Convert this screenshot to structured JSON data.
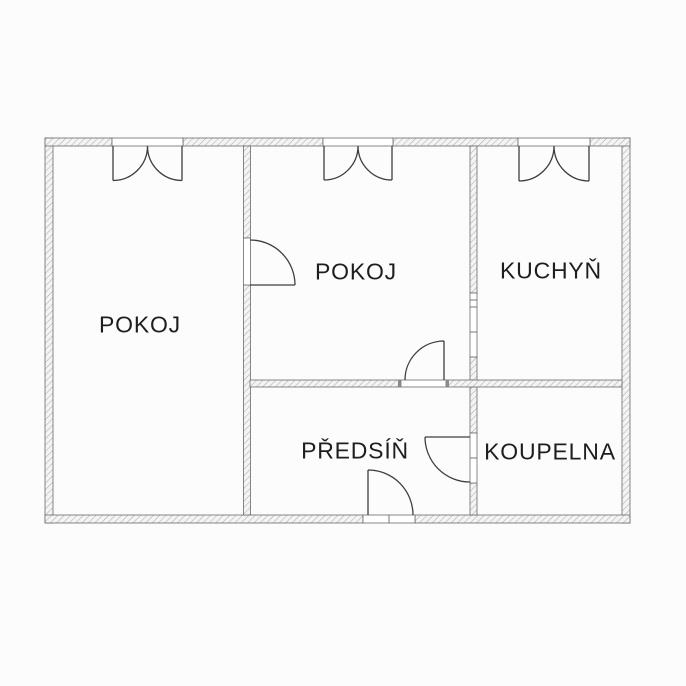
{
  "colors": {
    "background": "#fcfcfc",
    "wall_hatch": "#adadad",
    "wall_fill": "#f4f4f4",
    "wall_outline": "#6a6a6a",
    "line": "#3e3e3e",
    "text": "#1e1e1e"
  },
  "symbols": {
    "window": "casement-window-icon",
    "door": "door-swing-icon"
  },
  "rooms": [
    {
      "id": "pokoj-left",
      "label": "POKOJ"
    },
    {
      "id": "pokoj-middle",
      "label": "POKOJ"
    },
    {
      "id": "kuchyn",
      "label": "KUCHYŇ"
    },
    {
      "id": "predsin",
      "label": "PŘEDSÍŇ"
    },
    {
      "id": "koupelna",
      "label": "KOUPELNA"
    }
  ]
}
